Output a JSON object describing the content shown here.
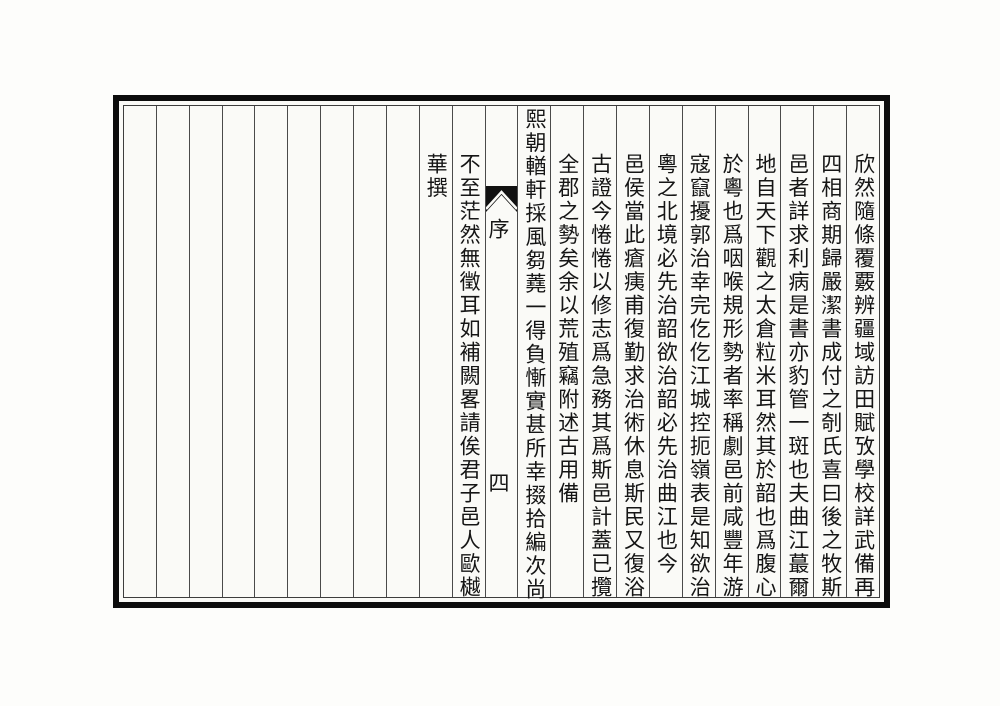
{
  "document": {
    "kind": "woodblock-print-scan",
    "script_direction": "vertical-rl",
    "colors": {
      "paper": "#fafaf7",
      "ink": "#151515",
      "frame": "#0c0c0c",
      "rule": "#4a4a4a"
    }
  },
  "banxin": {
    "fishtail_icon": "fishtail-ornament",
    "section_label": "序",
    "page_number": "四"
  },
  "columns": [
    {
      "type": "text",
      "raised": false,
      "text": "欣然隨條覆覈辨疆域訪田賦攷學校詳武備再"
    },
    {
      "type": "text",
      "raised": false,
      "text": "四相商期歸嚴潔書成付之剞氏喜曰後之牧斯"
    },
    {
      "type": "text",
      "raised": false,
      "text": "邑者詳求利病是書亦豹管一斑也夫曲江蕞爾"
    },
    {
      "type": "text",
      "raised": false,
      "text": "地自天下觀之太倉粒米耳然其於韶也爲腹心"
    },
    {
      "type": "text",
      "raised": false,
      "text": "於粵也爲咽喉規形勢者率稱劇邑前咸豐年游"
    },
    {
      "type": "text",
      "raised": false,
      "text": "寇竄擾郭治幸完仡仡江城控扼嶺表是知欲治"
    },
    {
      "type": "text",
      "raised": false,
      "text": "粵之北境必先治韶欲治韶必先治曲江也今"
    },
    {
      "type": "text",
      "raised": false,
      "text": "邑侯當此瘡痍甫復勤求治術休息斯民又復浴"
    },
    {
      "type": "text",
      "raised": false,
      "text": "古證今惓惓以修志爲急務其爲斯邑計蓋已攬"
    },
    {
      "type": "text",
      "raised": false,
      "text": "全郡之勢矣余以荒殖竊附述古用備"
    },
    {
      "type": "text",
      "raised": true,
      "text": "熙朝輶軒採風芻蕘一得負慚實甚所幸掇拾編次尚"
    },
    {
      "type": "banxin"
    },
    {
      "type": "text",
      "raised": false,
      "text": "不至茫然無徵耳如補闕畧請俟君子邑人歐樾"
    },
    {
      "type": "text",
      "raised": false,
      "text": "華撰"
    },
    {
      "type": "empty"
    },
    {
      "type": "empty"
    },
    {
      "type": "empty"
    },
    {
      "type": "empty"
    },
    {
      "type": "empty"
    },
    {
      "type": "empty"
    },
    {
      "type": "empty"
    },
    {
      "type": "empty"
    },
    {
      "type": "empty"
    }
  ]
}
